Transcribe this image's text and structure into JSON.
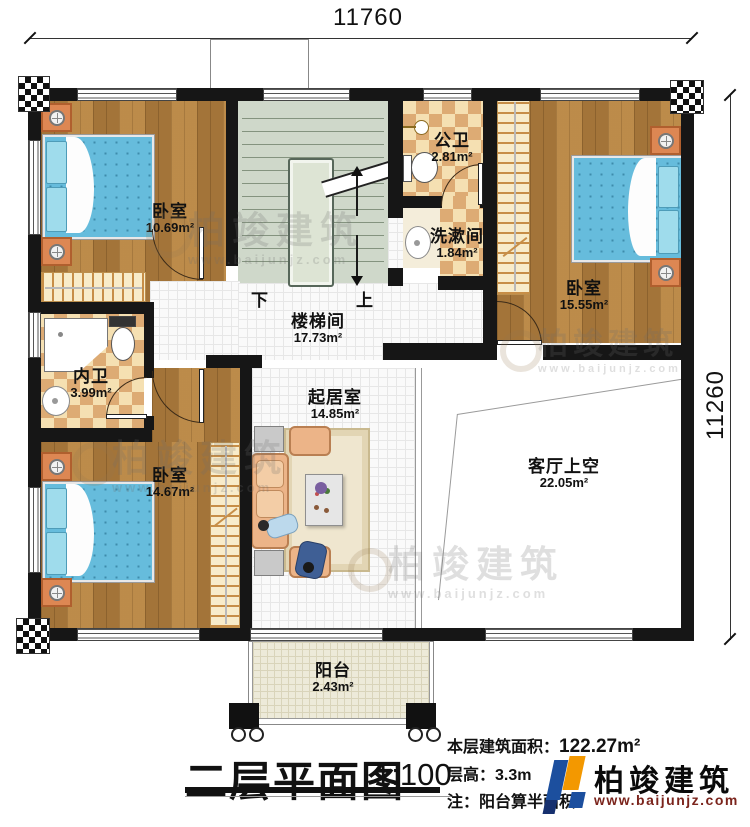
{
  "dimensions": {
    "top": "11760",
    "right": "11260"
  },
  "rooms": {
    "bedroom_tl": {
      "name": "卧室",
      "area": "10.69m²"
    },
    "bedroom_tr": {
      "name": "卧室",
      "area": "15.55m²"
    },
    "bedroom_bl": {
      "name": "卧室",
      "area": "14.67m²"
    },
    "public_bath": {
      "name": "公卫",
      "area": "2.81m²"
    },
    "washroom": {
      "name": "洗漱间",
      "area": "1.84m²"
    },
    "inner_bath": {
      "name": "内卫",
      "area": "3.99m²"
    },
    "stairwell": {
      "name": "楼梯间",
      "area": "17.73m²"
    },
    "living": {
      "name": "起居室",
      "area": "14.85m²"
    },
    "void_above_living": {
      "name": "客厅上空",
      "area": "22.05m²"
    },
    "balcony": {
      "name": "阳台",
      "area": "2.43m²"
    }
  },
  "stairs": {
    "down": "下",
    "up": "上"
  },
  "title": {
    "text": "二层平面图",
    "scale": "1:100"
  },
  "info": {
    "floor_area_label": "本层建筑面积：",
    "floor_area_value": "122.27m²",
    "floor_height_label": "层高：",
    "floor_height_value": "3.3m",
    "note": "注：阳台算半面积"
  },
  "logo": {
    "name": "柏竣建筑",
    "url": "www.baijunjz.com"
  },
  "watermark": {
    "text": "柏竣建筑",
    "url": "www.baijunjz.com"
  },
  "colors": {
    "wall": "#161616",
    "wood_floor": "#b5813f",
    "bed_blue": "#66bcdc",
    "bath_tile_dark": "#ddab74",
    "bath_tile_light": "#f5e0b2",
    "stair_green": "#cfd8ca",
    "logo_blue": "#1c4f9e",
    "logo_orange": "#f39800",
    "logo_url_red": "#7b241c"
  }
}
